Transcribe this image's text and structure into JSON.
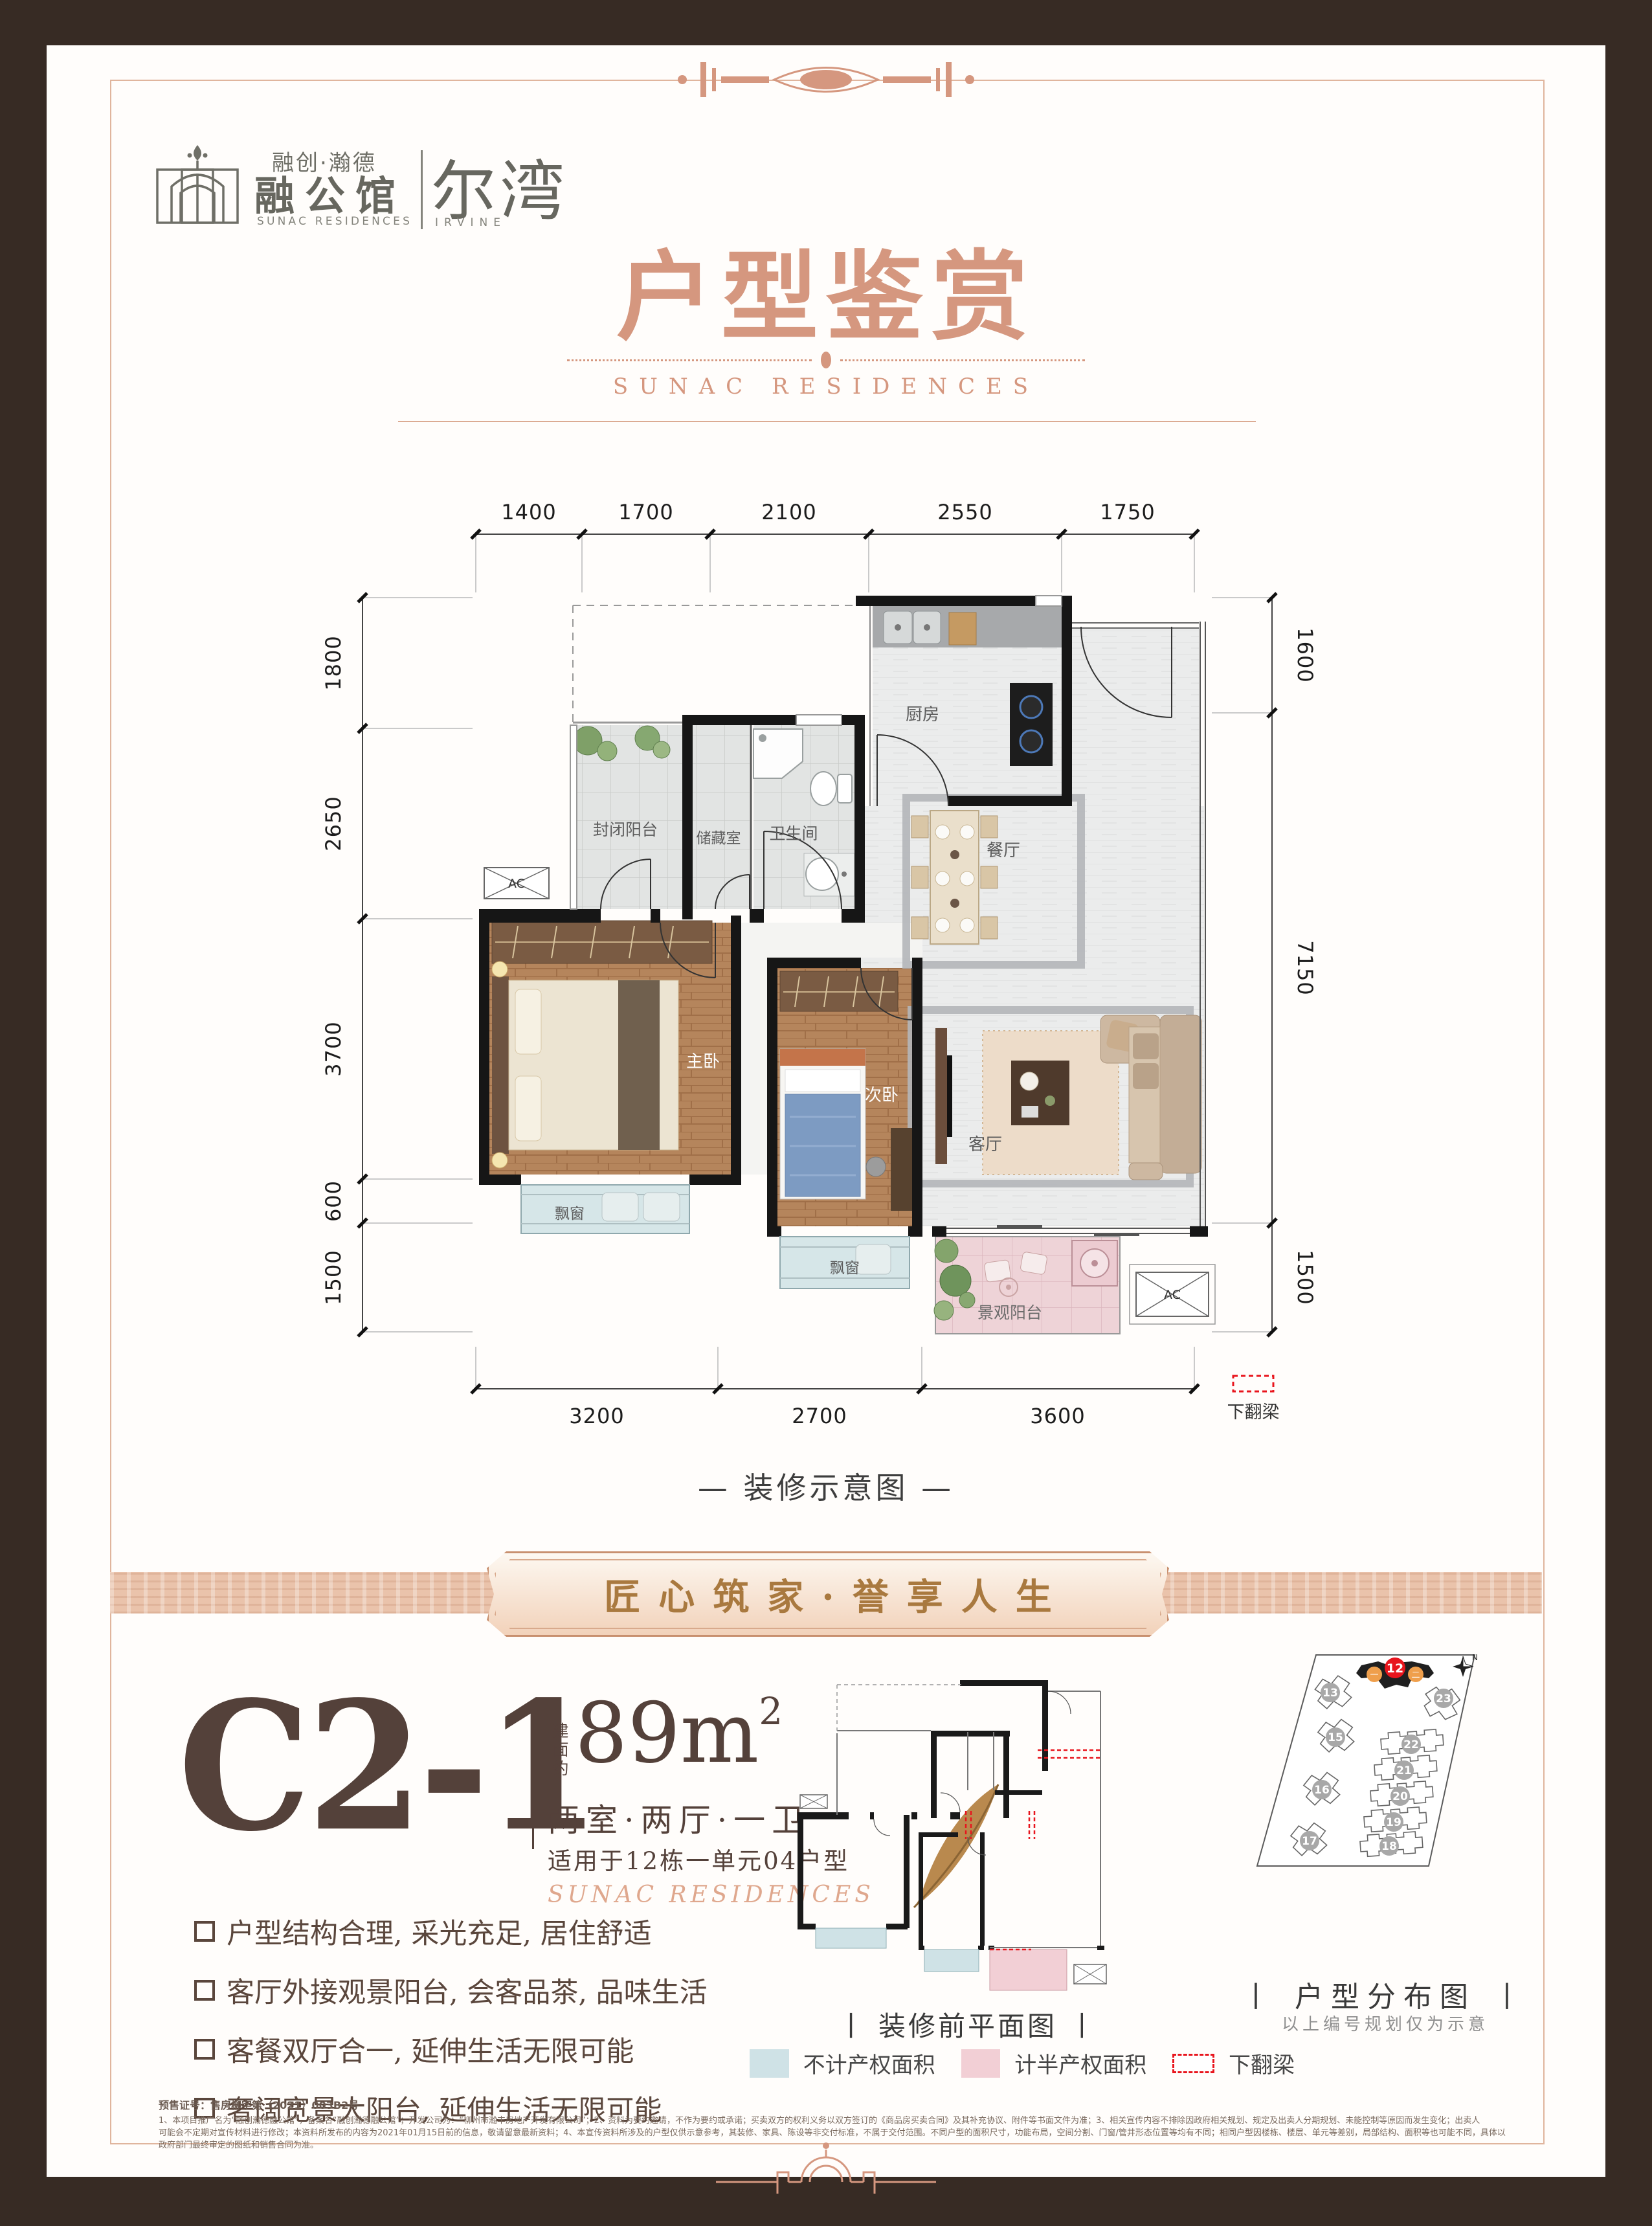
{
  "colors": {
    "accent": "#d5977f",
    "gold": "#a9793f",
    "brown": "#54413a",
    "frame": "#372b24",
    "beam_red": "#e8151d",
    "legend_blue": "#cfe2e6",
    "legend_pink": "#f2cfd5"
  },
  "logo": {
    "brand_line": "融创·瀚德",
    "brand_name": "融公馆",
    "brand_sub": "SUNAC RESIDENCES",
    "project_name": "尔湾",
    "project_sub": "IRVINE"
  },
  "hero": {
    "title": "户型鉴赏",
    "subtitle": "SUNAC RESIDENCES"
  },
  "plan": {
    "caption": "—  装修示意图  —",
    "dims_top": [
      "1400",
      "1700",
      "2100",
      "2550",
      "1750"
    ],
    "dims_left": [
      "1800",
      "2650",
      "3700",
      "600",
      "1500"
    ],
    "dims_right": [
      "1600",
      "7150",
      "1500"
    ],
    "dims_bottom": [
      "3200",
      "2700",
      "3600"
    ],
    "rooms": {
      "kitchen": "厨房",
      "dining": "餐厅",
      "closed_balcony": "封闭阳台",
      "storage": "储藏室",
      "bath": "卫生间",
      "master": "主卧",
      "second": "次卧",
      "living": "客厅",
      "view_balcony": "景观阳台",
      "bay_master": "飘窗",
      "bay_second": "飘窗",
      "ac": "AC",
      "ac2": "AC"
    },
    "beam": "下翻梁"
  },
  "banner": {
    "text": "匠心筑家·誉享人生"
  },
  "unit": {
    "code": "C2-1",
    "area_label": "建面约",
    "area_value": "89",
    "area_unit": "m",
    "area_sup": "2",
    "layout": "两室·两厅·一卫",
    "applicable": "适用于12栋一单元04户型",
    "script": "SUNAC RESIDENCES"
  },
  "features": {
    "items": [
      "户型结构合理, 采光充足, 居住舒适",
      "客厅外接观景阳台, 会客品茶, 品味生活",
      "客餐双厅合一, 延伸生活无限可能",
      "奢阔宽景大阳台, 延伸生活无限可能"
    ]
  },
  "preplan": {
    "caption": "丨 装修前平面图 丨",
    "legend": [
      {
        "label": "不计产权面积"
      },
      {
        "label": "计半产权面积"
      },
      {
        "label": "下翻梁"
      }
    ]
  },
  "siteplan": {
    "caption": "丨 户型分布图 丨",
    "note": "以上编号规划仅为示意",
    "highlight": "12",
    "unit_labels": [
      "一",
      "二"
    ],
    "buildings": [
      "13",
      "23",
      "15",
      "22",
      "21",
      "16",
      "20",
      "19",
      "18",
      "17"
    ],
    "north": "N"
  },
  "disclaimer": {
    "lines": [
      "预售证号：售房柳字第（2021）003B2号",
      "1、本项目推广名为“融创瀚德融公馆”，备案名“融创瀚德融公馆”；开发公司为：“柳州市瀚丰房地产开发有限公司”；2、资料为要约邀请，不作为要约或承诺；买卖双方的权利义务以双方签订的《商品房买卖合同》及其补充协议、附件等书面文件为准；3、相关宣传内容不排除因政府相关规划、规定及出卖人分期规划、未能控制等原因而发生变化；出卖人",
      "可能会不定期对宣传材料进行修改；本资料所发布的内容为2021年01月15日前的信息，敬请留意最新资料；4、本宣传资料所涉及的户型仅供示意参考，其装修、家具、陈设等非交付标准，不属于交付范围。不同户型的面积尺寸，功能布局，空间分割、门窗/管井形态位置等均有不同；相同户型因楼栋、楼层、单元等差别，局部结构、面积等也可能不同，具体以",
      "政府部门最终审定的图纸和销售合同为准。"
    ]
  }
}
